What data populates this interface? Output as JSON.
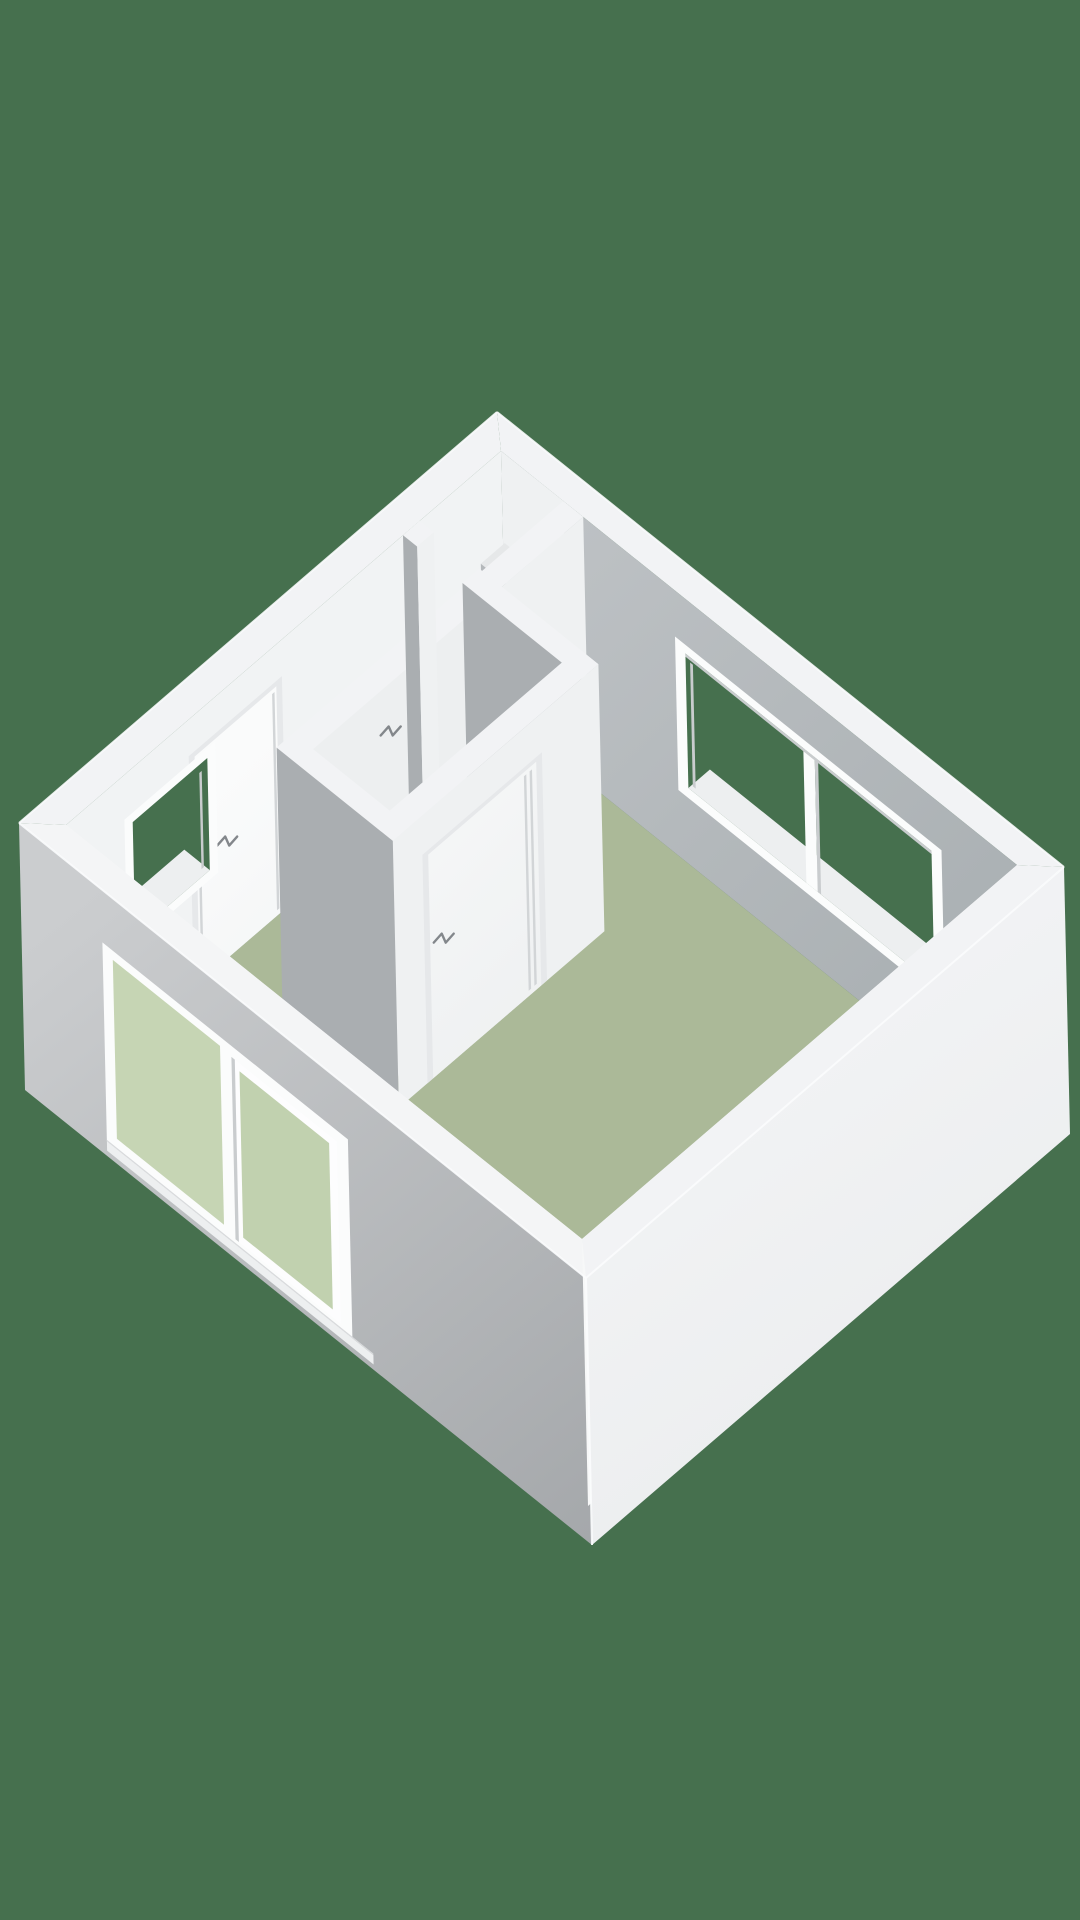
{
  "meta": {
    "aria_label": "3D isometric floor plan of a studio apartment with sage green floor, white walls, a closet, a bathroom with door, an entry door, two windows and a large sliding glass door",
    "view_label": "3d-floorplan-render"
  },
  "canvas": {
    "width": 1080,
    "height": 1920
  },
  "colors": {
    "background": "#46704e",
    "floor": "#abb998",
    "floor_bathroom": "#e9ebea",
    "wall_top": "#f2f3f5",
    "wall_top_front": "#f4f5f6",
    "nw_inner": "#f1f3f4",
    "ne_inner_light": "#bdc1c4",
    "ne_inner_dark": "#aab0b3",
    "closet_back": "#eff1f2",
    "sw_outer_light": "#cbcdcf",
    "sw_outer_dark": "#a5a8ab",
    "se_outer_light": "#f5f6f7",
    "se_outer_dark": "#e9ebed",
    "se_inner": "#f7f8f8",
    "sw_inner": "#f8f9fa",
    "int_wall_bright": "#eff1f2",
    "int_wall_bath": "#edeff0",
    "int_wall_gray": "#aaaeb1",
    "door_frame": "#e6e8ea",
    "door_leaf": "#f7f8f9",
    "door_line": "#d2d5d7",
    "handle": "#83878b",
    "window_frame": "#fbfcfc",
    "frame_shadow": "#c9ccce",
    "glass": "#c6d5b4",
    "glass_right": "#c1d1af",
    "glass_inner": "#ccd9bc",
    "sill": "#edeff0",
    "track_line": "#d8dadc",
    "shelf_front": "#b4b8bb",
    "shelf_top": "#e6e8e9",
    "edge_highlight": "#fbfcfd"
  },
  "projection": {
    "origin": [
      497,
      412
    ],
    "u_axis": [
      567,
      455
    ],
    "v_axis": [
      -478,
      411
    ],
    "drop": [
      6,
      267
    ]
  },
  "plan": {
    "t": 0.045,
    "ne_window": {
      "frame_u1": 0.35,
      "frame_u2": 0.82,
      "frame_z1": 0.25,
      "frame_z2": 0.825,
      "u1": 0.368,
      "u2": 0.802,
      "z1": 0.288,
      "z2": 0.792,
      "mull_u1": 0.576,
      "mull_u2": 0.596
    },
    "nw_window": {
      "frame_v1": 0.645,
      "frame_v2": 0.835,
      "frame_z1": 0.345,
      "frame_z2": 0.835,
      "v1": 0.662,
      "v2": 0.818,
      "z1": 0.38,
      "z2": 0.8
    },
    "entry_door": {
      "frame_v1": 0.505,
      "frame_v2": 0.7,
      "frame_z": 0.865,
      "v1": 0.517,
      "v2": 0.688,
      "z": 0.845,
      "handle_v": 0.625,
      "handle_z": 0.43
    },
    "sw_window": {
      "frame_u1": 0.145,
      "frame_u2": 0.578,
      "frame_z1": 0.055,
      "frame_z2": 0.8,
      "left_u1": 0.163,
      "left_u2": 0.352,
      "left_z1": 0.095,
      "left_z2": 0.765,
      "sash_u1": 0.372,
      "sash_u2": 0.558,
      "sash_z1": 0.075,
      "sash_z2": 0.758,
      "right_u1": 0.386,
      "right_u2": 0.544,
      "right_z1": 0.105,
      "right_z2": 0.728,
      "sill_u1": 0.145,
      "sill_u2": 0.615,
      "sill_z1": 0.02,
      "sill_z2": 0.055
    },
    "w1": {
      "u1": 0.155,
      "u2": 0.19,
      "v1": 0.045,
      "v2": 0.645
    },
    "w2": {
      "v1": 0.215,
      "v2": 0.25,
      "u1": 0.045,
      "u2": 0.36,
      "gap_u1": 0.07,
      "gap_u2": 0.15
    },
    "w3": {
      "u1": 0.325,
      "u2": 0.36,
      "v1": 0.215,
      "v2": 0.645
    },
    "w4": {
      "v1": 0.61,
      "v2": 0.645,
      "u1": 0.155,
      "u2": 0.36
    },
    "bath_floor": {
      "u1": 0.19,
      "u2": 0.325,
      "v1": 0.25,
      "v2": 0.61
    },
    "bath_door": {
      "frame_v1": 0.335,
      "frame_v2": 0.585,
      "frame_z": 0.855,
      "v1": 0.347,
      "v2": 0.573,
      "z": 0.838,
      "hinge_v1": 0.356,
      "hinge_v2": 0.368,
      "handle_v": 0.545,
      "handle_z": 0.48
    },
    "closet": {
      "u1": 0.045,
      "u2": 0.155,
      "v1": 0.045,
      "v2": 0.215
    },
    "shelf": {
      "u1": 0.048,
      "u2": 0.155,
      "v_front": 0.095,
      "z1": 0.58,
      "z2": 0.66
    },
    "wall_mark": {
      "u": 0.19,
      "v": 0.45,
      "z": 0.82
    }
  }
}
